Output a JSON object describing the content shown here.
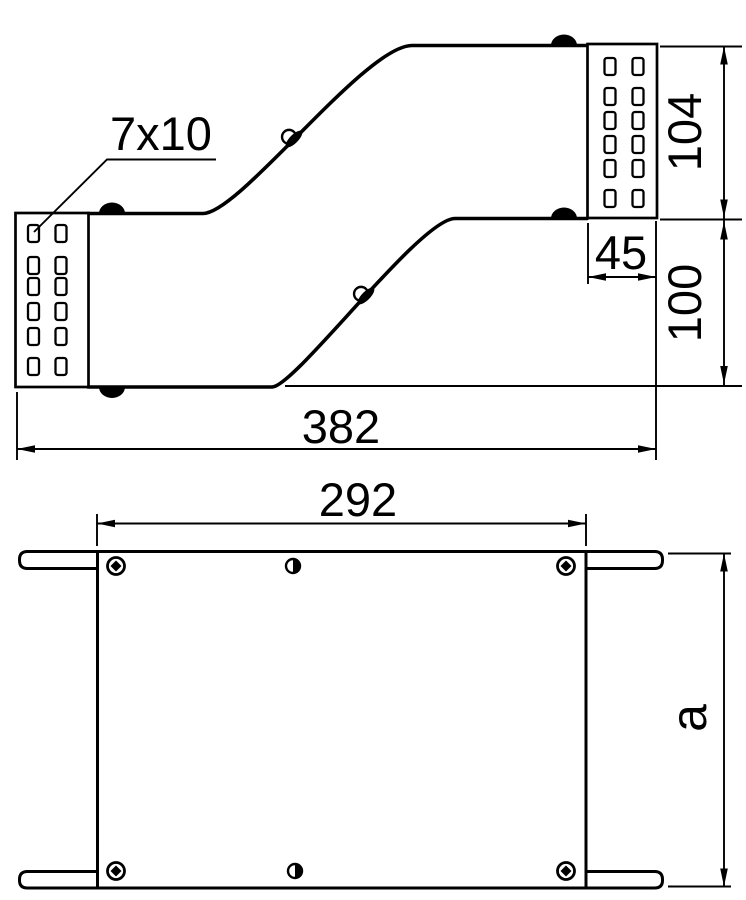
{
  "colors": {
    "ink": "#000000",
    "paper": "#ffffff"
  },
  "side_view": {
    "slot_label": "7x10",
    "dim_overall_length": "382",
    "dim_end_height": "104",
    "dim_connector_length": "45",
    "dim_offset_height": "100"
  },
  "plan_view": {
    "dim_hole_span": "292",
    "dim_width_label": "a"
  }
}
